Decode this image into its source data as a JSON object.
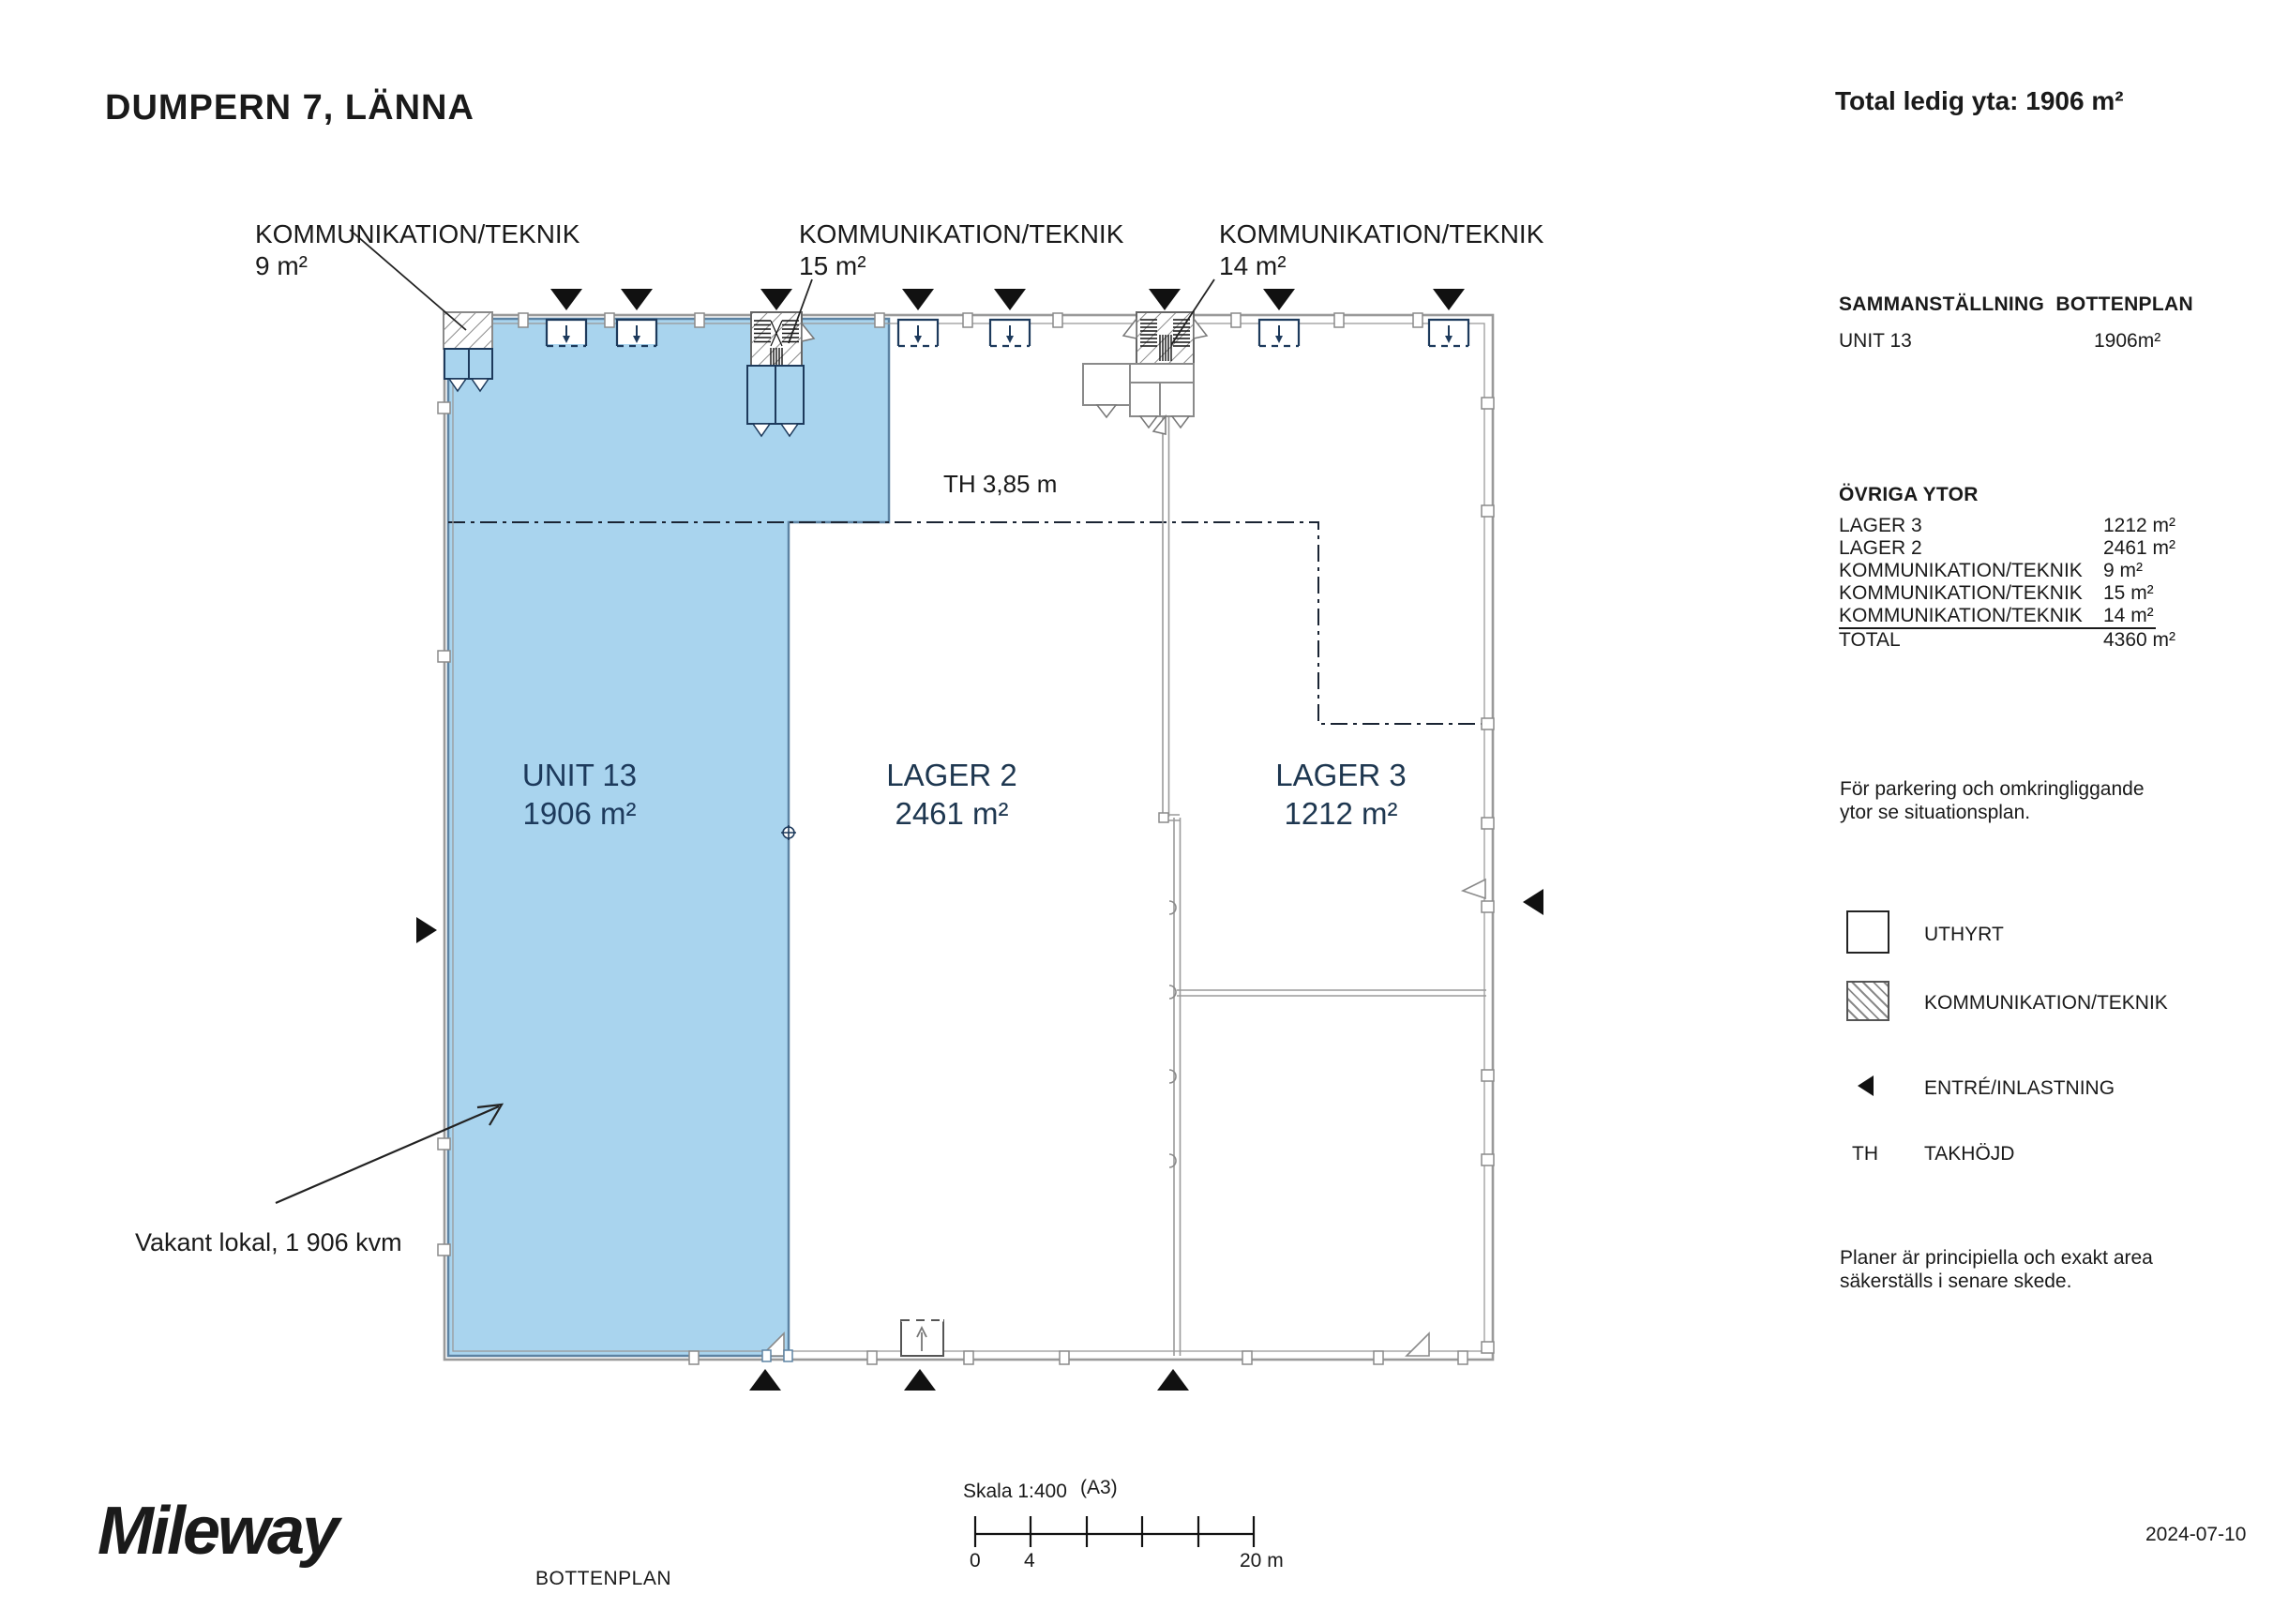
{
  "header": {
    "title": "DUMPERN 7, LÄNNA",
    "total": "Total ledig yta: 1906 m²"
  },
  "plan": {
    "komm_labels": [
      {
        "name": "KOMMUNIKATION/TEKNIK",
        "area": "9 m²"
      },
      {
        "name": "KOMMUNIKATION/TEKNIK",
        "area": "15 m²"
      },
      {
        "name": "KOMMUNIKATION/TEKNIK",
        "area": "14 m²"
      }
    ],
    "rooms": {
      "unit13": {
        "name": "UNIT 13",
        "area": "1906 m²"
      },
      "lager2": {
        "name": "LAGER 2",
        "area": "2461 m²"
      },
      "lager3": {
        "name": "LAGER 3",
        "area": "1212 m²"
      }
    },
    "ceiling_height": "TH 3,85 m",
    "vacant_note": "Vakant lokal, 1 906 kvm"
  },
  "sidebar": {
    "summary_heading": "SAMMANSTÄLLNING  BOTTENPLAN",
    "summary_rows": [
      {
        "label": "UNIT 13",
        "value": "1906m²"
      }
    ],
    "ovriga_heading": "ÖVRIGA YTOR",
    "ovriga_rows": [
      {
        "label": "LAGER 3",
        "value": "1212 m²"
      },
      {
        "label": "LAGER 2",
        "value": "2461 m²"
      },
      {
        "label": "KOMMUNIKATION/TEKNIK",
        "value": "9 m²"
      },
      {
        "label": "KOMMUNIKATION/TEKNIK",
        "value": "15 m²"
      },
      {
        "label": "KOMMUNIKATION/TEKNIK",
        "value": "14 m²"
      },
      {
        "label": "TOTAL",
        "value": "4360 m²"
      }
    ],
    "parking_note": "För parkering och omkringliggande ytor se situationsplan.",
    "legend": {
      "uthyrt": "UTHYRT",
      "kommunikation": "KOMMUNIKATION/TEKNIK",
      "entre": "ENTRÉ/INLASTNING",
      "th_abbr": "TH",
      "th_label": "TAKHÖJD"
    },
    "disclaimer": "Planer är principiella och exakt area säkerställs i senare skede."
  },
  "footer": {
    "logo": "Mileway",
    "plan_name": "BOTTENPLAN",
    "scale": "Skala 1:400",
    "paper": "(A3)",
    "scale_ticks": {
      "start": "0",
      "second": "4",
      "end": "20 m"
    },
    "date": "2024-07-10"
  },
  "colors": {
    "unit_fill": "#A9D4EE",
    "wall_gray": "#9a9a9a",
    "navy": "#1d3a5c"
  }
}
